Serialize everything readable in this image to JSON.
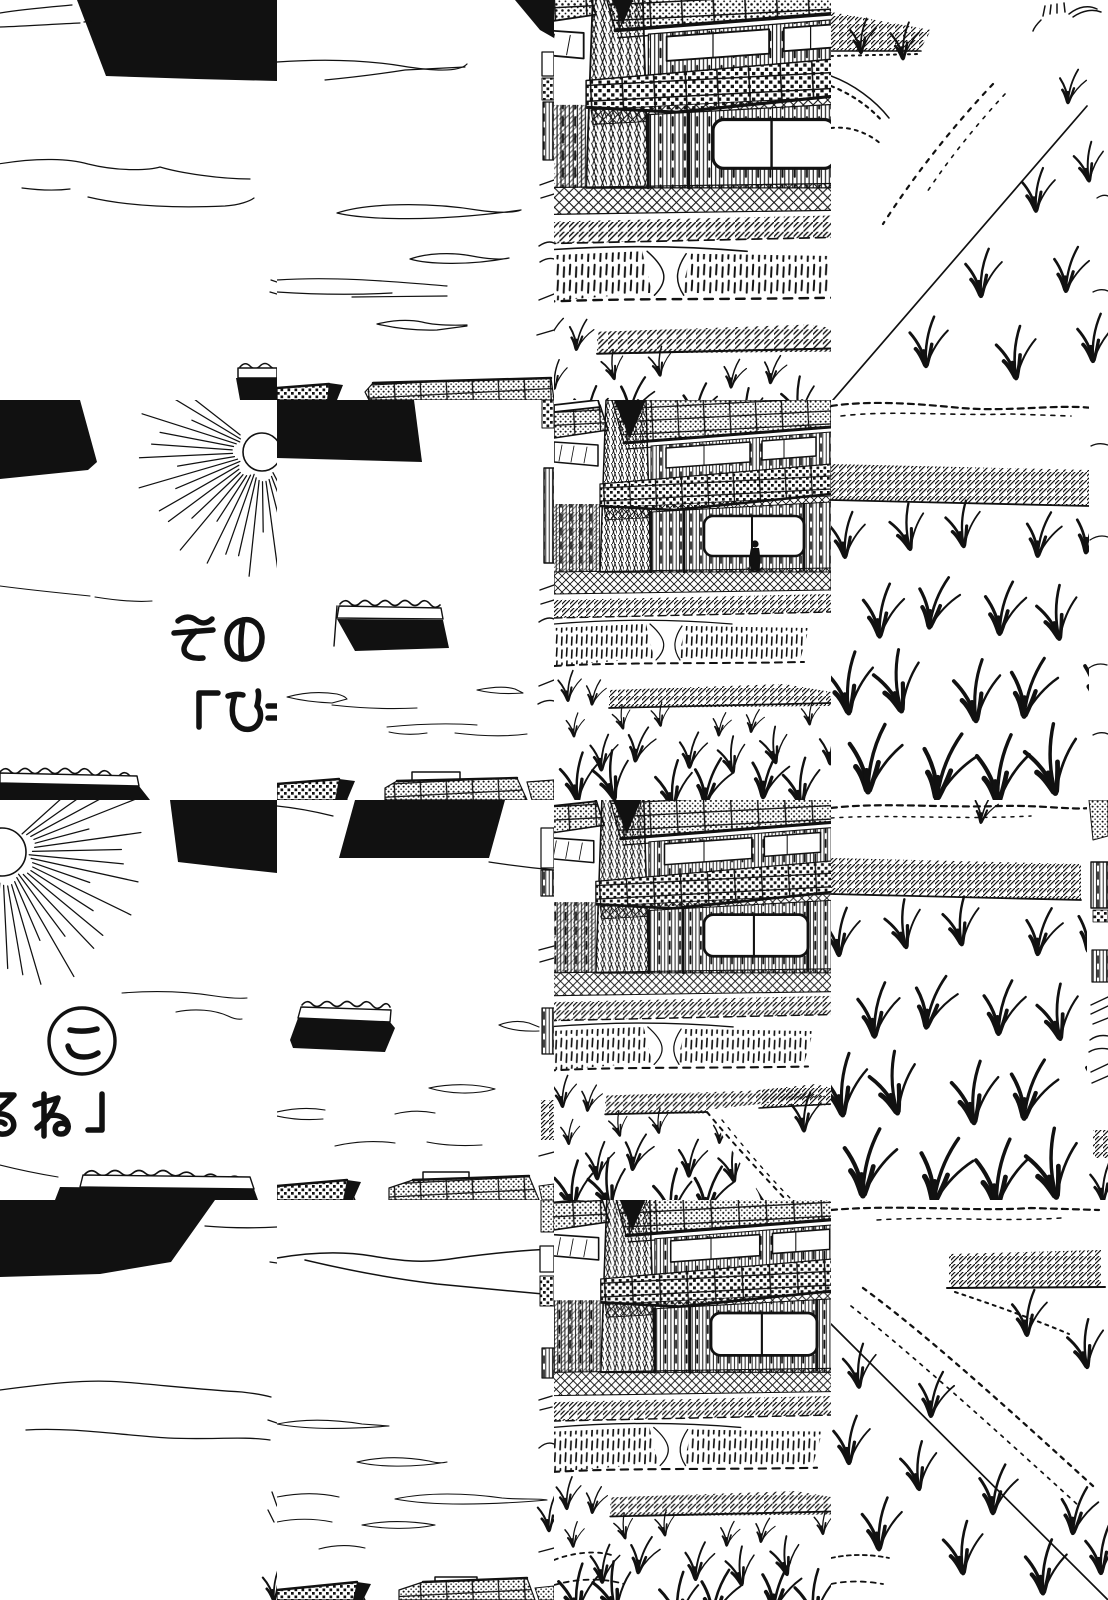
{
  "colors": {
    "ink": "#111111",
    "paper": "#ffffff"
  },
  "text": {
    "line1": "その",
    "line2": "「ひ",
    "circled_char": "こ",
    "line3": "るね」"
  }
}
